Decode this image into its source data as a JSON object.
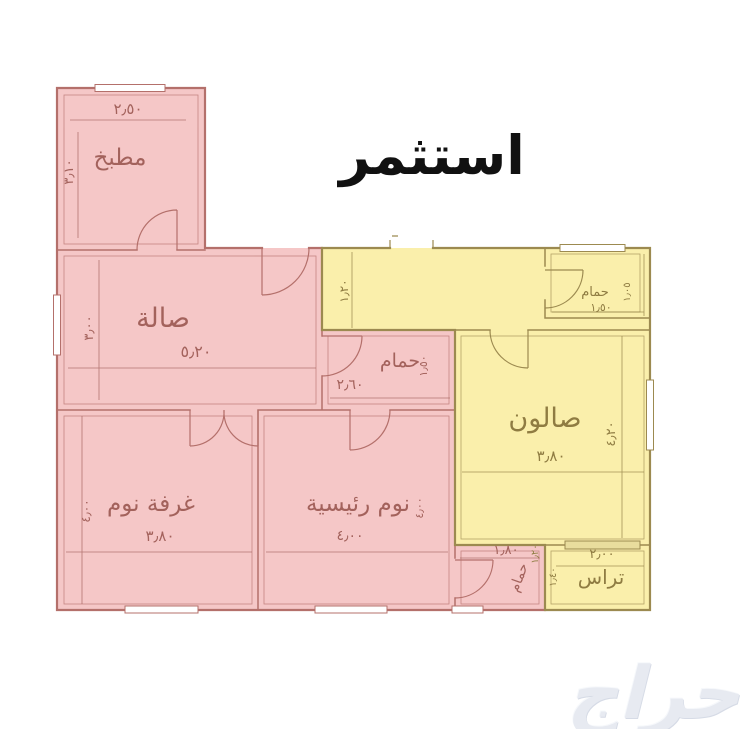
{
  "title": "استثمر",
  "watermark": "حراج",
  "colors": {
    "pink_fill": "#f5c7c7",
    "pink_wall": "#b4706b",
    "pink_text": "#a3625c",
    "yellow_fill": "#faefab",
    "yellow_wall": "#9c8a50",
    "yellow_text": "#8f7c42",
    "title_color": "#111111",
    "watermark_color": "#e7eaf1"
  },
  "plan": {
    "rooms": [
      {
        "name": "kitchen",
        "label": "مطبخ",
        "width_dim": "٢٫٥٠",
        "height_dim": "٣٫١٠",
        "zone": "pink"
      },
      {
        "name": "hall",
        "label": "صالة",
        "width_dim": "٥٫٢٠",
        "height_dim": "٣٫٠٠",
        "zone": "pink"
      },
      {
        "name": "bathroom-middle",
        "label": "حمام",
        "width_dim": "٢٫٦٠",
        "height_dim": "١٫٥٠",
        "zone": "pink"
      },
      {
        "name": "bedroom",
        "label": "غرفة نوم",
        "width_dim": "٣٫٨٠",
        "height_dim": "٤٫٠٠",
        "zone": "pink"
      },
      {
        "name": "master-bedroom",
        "label": "نوم رئيسية",
        "width_dim": "٤٫٠٠",
        "height_dim": "٤٫٠٠",
        "zone": "pink"
      },
      {
        "name": "bathroom-bottom",
        "label": "حمام",
        "width_dim": "١٫٨٠",
        "height_dim": "١٫٤٠",
        "zone": "pink"
      },
      {
        "name": "entry-corridor",
        "label": "",
        "width_dim": "",
        "height_dim": "١٫٢٠",
        "zone": "yellow"
      },
      {
        "name": "bathroom-top",
        "label": "حمام",
        "width_dim": "١٫٥٠",
        "height_dim": "١٫٠٥",
        "zone": "yellow"
      },
      {
        "name": "salon",
        "label": "صالون",
        "width_dim": "٣٫٨٠",
        "height_dim": "٤٫٢٠",
        "zone": "yellow"
      },
      {
        "name": "terrace",
        "label": "تراس",
        "width_dim": "٢٫٠٠",
        "height_dim": "",
        "zone": "yellow"
      }
    ],
    "labels": [
      {
        "name": "label-kitchen",
        "text": "مطبخ",
        "x": 120,
        "y": 165,
        "size": 23,
        "rotate": 0,
        "zone": "pink"
      },
      {
        "name": "dim-kitchen-width",
        "text": "٢٫٥٠",
        "x": 128,
        "y": 114,
        "size": 15,
        "rotate": 0,
        "zone": "pink"
      },
      {
        "name": "dim-kitchen-height",
        "text": "٣٫١٠",
        "x": 73,
        "y": 172,
        "size": 13,
        "rotate": -90,
        "zone": "pink"
      },
      {
        "name": "label-hall",
        "text": "صالة",
        "x": 163,
        "y": 327,
        "size": 27,
        "rotate": 0,
        "zone": "pink"
      },
      {
        "name": "dim-hall-width",
        "text": "٥٫٢٠",
        "x": 196,
        "y": 357,
        "size": 16,
        "rotate": 0,
        "zone": "pink"
      },
      {
        "name": "dim-hall-height",
        "text": "٣٫٠٠",
        "x": 93,
        "y": 328,
        "size": 13,
        "rotate": -90,
        "zone": "pink"
      },
      {
        "name": "label-bathroom-middle",
        "text": "حمام",
        "x": 400,
        "y": 367,
        "size": 19,
        "rotate": 0,
        "zone": "pink"
      },
      {
        "name": "dim-bathroom-middle-width",
        "text": "٢٫٦٠",
        "x": 350,
        "y": 389,
        "size": 14,
        "rotate": 0,
        "zone": "pink"
      },
      {
        "name": "dim-bathroom-middle-height",
        "text": "١٫٥٠",
        "x": 427,
        "y": 366,
        "size": 11,
        "rotate": -90,
        "zone": "pink"
      },
      {
        "name": "dim-corridor-width",
        "text": "١٫٢٠",
        "x": 348,
        "y": 291,
        "size": 12,
        "rotate": -90,
        "zone": "yellow"
      },
      {
        "name": "label-bathroom-top",
        "text": "حمام",
        "x": 595,
        "y": 296,
        "size": 13,
        "rotate": 0,
        "zone": "yellow"
      },
      {
        "name": "dim-bathroom-top-width",
        "text": "١٫٥٠",
        "x": 601,
        "y": 311,
        "size": 11,
        "rotate": 0,
        "zone": "yellow"
      },
      {
        "name": "dim-bathroom-top-height",
        "text": "١٫٠٥",
        "x": 630,
        "y": 292,
        "size": 10,
        "rotate": -90,
        "zone": "yellow"
      },
      {
        "name": "label-salon",
        "text": "صالون",
        "x": 545,
        "y": 427,
        "size": 27,
        "rotate": 0,
        "zone": "yellow"
      },
      {
        "name": "dim-salon-width",
        "text": "٣٫٨٠",
        "x": 551,
        "y": 461,
        "size": 15,
        "rotate": 0,
        "zone": "yellow"
      },
      {
        "name": "dim-salon-height",
        "text": "٤٫٢٠",
        "x": 615,
        "y": 434,
        "size": 13,
        "rotate": -90,
        "zone": "yellow"
      },
      {
        "name": "label-bedroom",
        "text": "غرفة نوم",
        "x": 151,
        "y": 511,
        "size": 23,
        "rotate": 0,
        "zone": "pink"
      },
      {
        "name": "dim-bedroom-width",
        "text": "٣٫٨٠",
        "x": 160,
        "y": 541,
        "size": 15,
        "rotate": 0,
        "zone": "pink"
      },
      {
        "name": "dim-bedroom-height",
        "text": "٤٫٠٠",
        "x": 90,
        "y": 511,
        "size": 12,
        "rotate": -90,
        "zone": "pink"
      },
      {
        "name": "label-master-bedroom",
        "text": "نوم رئيسية",
        "x": 358,
        "y": 511,
        "size": 23,
        "rotate": 0,
        "zone": "pink"
      },
      {
        "name": "dim-master-bedroom-width",
        "text": "٤٫٠٠",
        "x": 350,
        "y": 540,
        "size": 14,
        "rotate": 0,
        "zone": "pink"
      },
      {
        "name": "dim-master-bedroom-height",
        "text": "٤٫٠٠",
        "x": 423,
        "y": 508,
        "size": 11,
        "rotate": -90,
        "zone": "pink"
      },
      {
        "name": "dim-bathroom-bottom-width",
        "text": "١٫٨٠",
        "x": 506,
        "y": 554,
        "size": 13,
        "rotate": 0,
        "zone": "pink"
      },
      {
        "name": "label-bathroom-bottom",
        "text": "حمام",
        "x": 523,
        "y": 579,
        "size": 14,
        "rotate": -70,
        "zone": "pink"
      },
      {
        "name": "dim-salon-bathroom",
        "text": "١٫٢٠",
        "x": 538,
        "y": 554,
        "size": 10,
        "rotate": -90,
        "zone": "yellow"
      },
      {
        "name": "dim-bathroom-terrace",
        "text": "١٫٤٠",
        "x": 556,
        "y": 577,
        "size": 10,
        "rotate": -90,
        "zone": "yellow"
      },
      {
        "name": "dim-terrace-width",
        "text": "٢٫٠٠",
        "x": 602,
        "y": 558,
        "size": 13,
        "rotate": 0,
        "zone": "yellow"
      },
      {
        "name": "label-terrace",
        "text": "تراس",
        "x": 601,
        "y": 584,
        "size": 20,
        "rotate": 0,
        "zone": "yellow"
      }
    ]
  }
}
